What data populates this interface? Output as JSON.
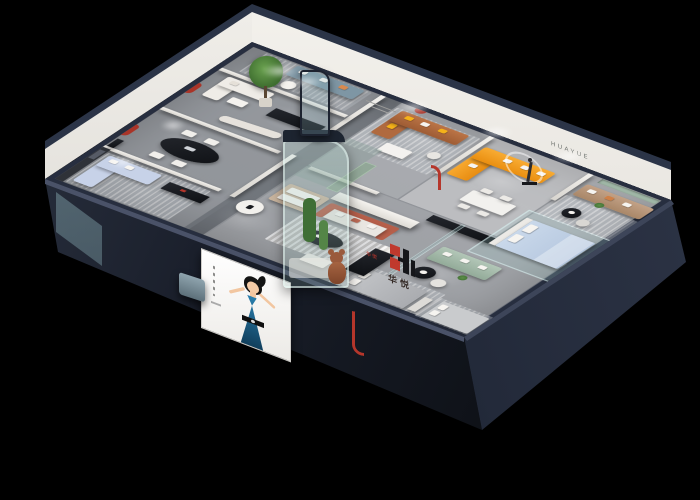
{
  "scene": {
    "description": "Isometric 3D cutaway render of a furniture showroom apartment at night on a black background",
    "background": "#000000"
  },
  "brand": {
    "logo_mark": "H",
    "logo_name": "华悦",
    "wall_letters": "HUAYUE",
    "display_label": "华悦"
  },
  "palette": {
    "outer_wall": "#272e3f",
    "floor_gray": "#95989d",
    "interior_wall": "#efece7",
    "accent_red": "#a93428",
    "sofa_orange": "#f49a1b",
    "sofa_brown": "#b06a3f",
    "sofa_blue_gray": "#7e96a4",
    "sofa_light_blue": "#c7d2e8",
    "sofa_sage": "#a9bfae",
    "sofa_terracotta": "#b65f4a",
    "sofa_tan": "#b9977d",
    "plant_green": "#4e7d3d",
    "glass_teal": "rgba(165,205,205,0.25)",
    "promo_dress_blue": "#1b6a93"
  }
}
